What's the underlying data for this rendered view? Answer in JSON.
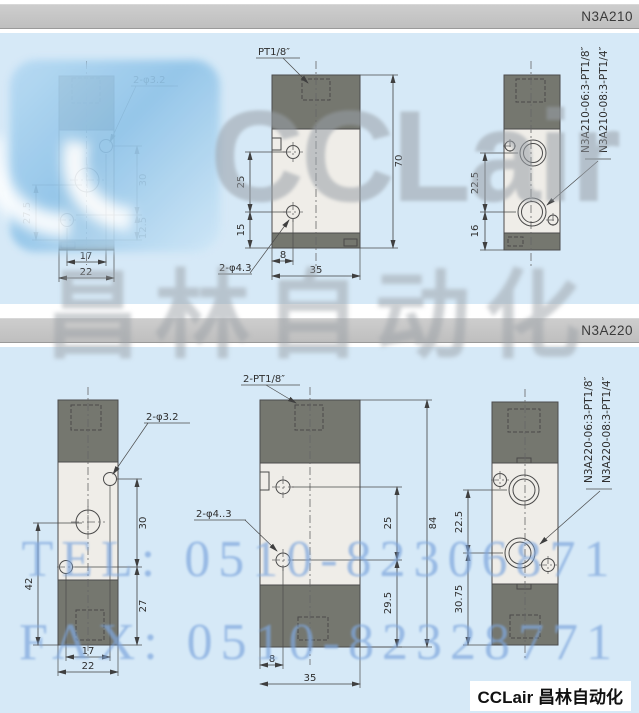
{
  "header1": {
    "model": "N3A210"
  },
  "header2": {
    "model": "N3A220"
  },
  "watermark": {
    "brand": "CCLair",
    "brand_cn": "昌林自动化",
    "tel": "TEL: 0510-82306871",
    "fax": "FAX: 0510-82328771"
  },
  "footer": {
    "text": "CCLair 昌林自动化"
  },
  "n3a210": {
    "front": {
      "hole": "2-φ3.2",
      "d1": "27.5",
      "d2": "30",
      "d3": "12.5",
      "d4": "17",
      "d5": "22"
    },
    "side": {
      "port": "PT1/8″",
      "hole": "2-φ4.3",
      "d1": "25",
      "d2": "15",
      "d3": "70",
      "d4": "8",
      "d5": "35"
    },
    "back": {
      "label1": "N3A210-06:3-PT1/8″",
      "label2": "N3A210-08:3-PT1/4″",
      "d1": "22.5",
      "d2": "16"
    }
  },
  "n3a220": {
    "front": {
      "hole": "2-φ3.2",
      "d1": "42",
      "d2": "30",
      "d3": "27",
      "d4": "17",
      "d5": "22"
    },
    "side": {
      "port": "2-PT1/8″",
      "hole": "2-φ4..3",
      "d1": "25",
      "d2": "84",
      "d3": "29.5",
      "d4": "8",
      "d5": "35"
    },
    "back": {
      "label1": "N3A220-06:3-PT1/8″",
      "label2": "N3A220-08:3-PT1/4″",
      "d1": "22.5",
      "d2": "30.75"
    }
  }
}
